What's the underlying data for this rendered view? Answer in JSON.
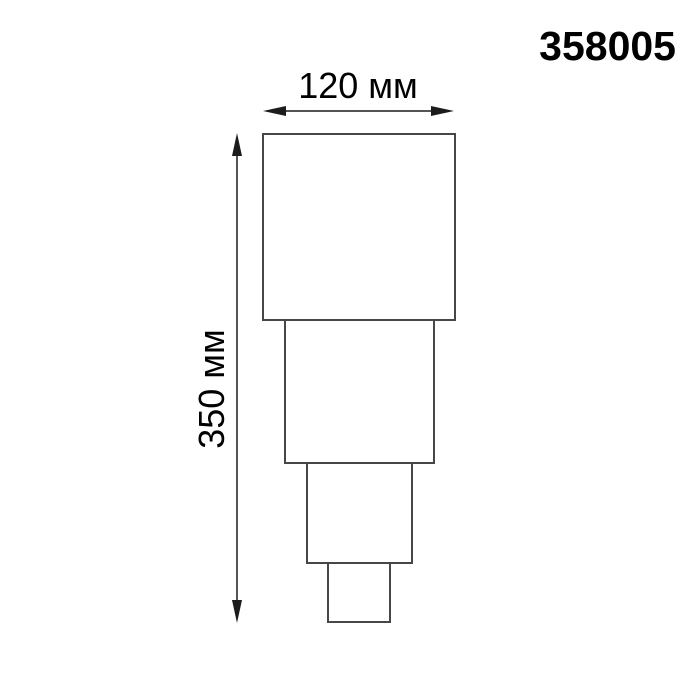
{
  "header": {
    "product_code": "358005"
  },
  "dimensions": {
    "width_label": "120 мм",
    "height_label": "350 мм"
  },
  "drawing": {
    "description": "Front-view line drawing of a stepped fixture: four stacked white rectangles, widest on top, narrowing toward the bottom",
    "segment_count": 4
  },
  "colors": {
    "background": "#ffffff",
    "text": "#000000",
    "dimension_line": "#1c1c1c",
    "outline": "#474747",
    "fill": "#ffffff"
  }
}
